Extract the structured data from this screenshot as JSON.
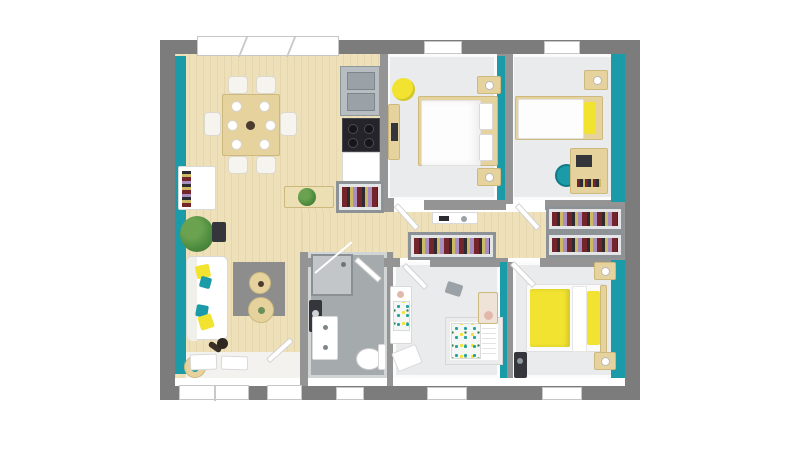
{
  "scene": {
    "type": "floor-plan-3d-top-view",
    "description": "Top-down 3D render of a single-storey house with grey exterior walls, teal accent walls, wood floor living area and four rooms off a central hallway",
    "background": "#ffffff"
  },
  "colors": {
    "background": "#ffffff",
    "outer_wall": "#7c7c7c",
    "inner_wall": "#949494",
    "frame": "#8d9296",
    "teal": "#1b9aa8",
    "wood": "#eee0b9",
    "floor_light": "#eaebed",
    "bath": "#a5abad",
    "rug": "#8d8d8d",
    "furn_wood": "#e6d29d",
    "yellow": "#f1e32f",
    "steel": "#b7bdc1",
    "dark": "#34363c",
    "plant": "#4e8c3f",
    "pink": "#e2b8ad",
    "dot_teal": "#26a29c",
    "clothes_a": "#74242b",
    "clothes_b": "#2b2b31",
    "clothes_c": "#cdb964",
    "clothes_d": "#a98fc0"
  },
  "rooms": [
    {
      "name": "living-dining-kitchen",
      "floor": "wood",
      "furniture": [
        "dining-table",
        "six-chairs",
        "tableware",
        "sink-unit",
        "cooktop",
        "base-cabinet",
        "shoe-wardrobe",
        "sideboard-with-plant",
        "bookshelf",
        "potted-plant",
        "sofa",
        "throw-pillows",
        "rug",
        "coffee-tables",
        "floor-lamp",
        "side-table",
        "doormats"
      ]
    },
    {
      "name": "bedroom-1",
      "floor": "light",
      "furniture": [
        "double-bed",
        "two-nightstands",
        "bedside-lamps",
        "media-shelf",
        "beanbag"
      ]
    },
    {
      "name": "bedroom-2",
      "floor": "light",
      "furniture": [
        "single-bed",
        "nightstand",
        "desk",
        "desk-chair"
      ]
    },
    {
      "name": "hallway",
      "floor": "wood",
      "furniture": [
        "console-table",
        "built-in-wardrobe",
        "built-in-wardrobe",
        "built-in-wardrobe"
      ]
    },
    {
      "name": "bathroom",
      "floor": "tile",
      "furniture": [
        "corner-shower",
        "washing-machine",
        "vanity-sink",
        "toilet"
      ]
    },
    {
      "name": "nursery",
      "floor": "light",
      "furniture": [
        "crib",
        "changing-table",
        "dresser",
        "floor-cushion",
        "toy"
      ]
    },
    {
      "name": "master-bedroom",
      "floor": "light",
      "furniture": [
        "double-bed-yellow",
        "two-nightstands",
        "wardrobe",
        "speaker"
      ]
    }
  ]
}
